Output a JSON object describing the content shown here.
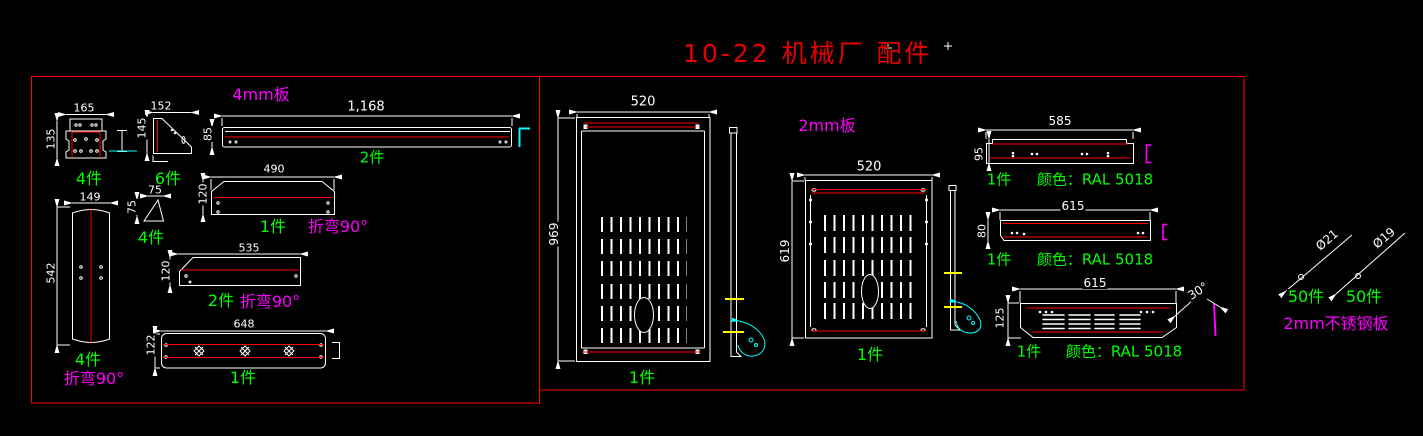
{
  "title": {
    "text": "10-22 机械厂 配件"
  },
  "colors": {
    "w": "#ffffff",
    "g": "#00ff00",
    "m": "#ff00ff",
    "r": "#e60000",
    "line_red": "#ff0000",
    "cyan": "#00ffff",
    "yellow": "#ffff00",
    "background": "#000000"
  },
  "annotations": [
    {
      "name": "dim-bracket-width",
      "text": "165",
      "x": 84,
      "y": 108,
      "s": 11
    },
    {
      "name": "dim-bracket-height",
      "text": "135",
      "x": 51,
      "y": 139,
      "s": 11,
      "rot": -90
    },
    {
      "name": "qty-bracket",
      "text": "4件",
      "x": 89,
      "y": 179,
      "s": 16,
      "c": "g"
    },
    {
      "name": "dim-gusset-width",
      "text": "152",
      "x": 161,
      "y": 106,
      "s": 11
    },
    {
      "name": "dim-gusset-height",
      "text": "145",
      "x": 142,
      "y": 128,
      "s": 11,
      "rot": -90
    },
    {
      "name": "qty-gusset",
      "text": "6件",
      "x": 168,
      "y": 179,
      "s": 16,
      "c": "g"
    },
    {
      "name": "material-left-box",
      "text": "4mm板",
      "x": 261,
      "y": 95,
      "s": 16,
      "c": "m"
    },
    {
      "name": "dim-longbar-length",
      "text": "1,168",
      "x": 366,
      "y": 107,
      "s": 13
    },
    {
      "name": "dim-longbar-height",
      "text": "85",
      "x": 208,
      "y": 134,
      "s": 11,
      "rot": -90
    },
    {
      "name": "qty-longbar",
      "text": "2件",
      "x": 372,
      "y": 158,
      "s": 15,
      "c": "g"
    },
    {
      "name": "dim-tray490-length",
      "text": "490",
      "x": 274,
      "y": 169,
      "s": 11
    },
    {
      "name": "dim-tray490-height",
      "text": "120",
      "x": 203,
      "y": 194,
      "s": 11,
      "rot": -90
    },
    {
      "name": "qty-tray490",
      "text": "1件",
      "x": 273,
      "y": 227,
      "s": 16,
      "c": "g"
    },
    {
      "name": "note-tray490-bend",
      "text": "折弯90°",
      "x": 338,
      "y": 227,
      "s": 16,
      "c": "m"
    },
    {
      "name": "dim-tallpanel-width",
      "text": "149",
      "x": 90,
      "y": 197,
      "s": 11
    },
    {
      "name": "dim-tallpanel-height",
      "text": "542",
      "x": 51,
      "y": 273,
      "s": 11,
      "rot": -90
    },
    {
      "name": "qty-tallpanel",
      "text": "4件",
      "x": 88,
      "y": 360,
      "s": 16,
      "c": "g"
    },
    {
      "name": "note-tallpanel-bend",
      "text": "折弯90°",
      "x": 94,
      "y": 379,
      "s": 16,
      "c": "m"
    },
    {
      "name": "dim-gusset75-width",
      "text": "75",
      "x": 155,
      "y": 190,
      "s": 11
    },
    {
      "name": "dim-gusset75-height",
      "text": "75",
      "x": 132,
      "y": 207,
      "s": 11,
      "rot": -90
    },
    {
      "name": "qty-gusset75",
      "text": "4件",
      "x": 151,
      "y": 238,
      "s": 16,
      "c": "g"
    },
    {
      "name": "dim-tray535-length",
      "text": "535",
      "x": 249,
      "y": 248,
      "s": 11
    },
    {
      "name": "dim-tray535-height",
      "text": "120",
      "x": 166,
      "y": 271,
      "s": 11,
      "rot": -90
    },
    {
      "name": "qty-tray535",
      "text": "2件",
      "x": 221,
      "y": 301,
      "s": 16,
      "c": "g"
    },
    {
      "name": "note-tray535-bend",
      "text": "折弯90°",
      "x": 270,
      "y": 302,
      "s": 16,
      "c": "m"
    },
    {
      "name": "dim-bar648-length",
      "text": "648",
      "x": 244,
      "y": 324,
      "s": 11
    },
    {
      "name": "dim-bar648-height",
      "text": "122",
      "x": 151,
      "y": 345,
      "s": 11,
      "rot": -90
    },
    {
      "name": "qty-bar648",
      "text": "1件",
      "x": 243,
      "y": 378,
      "s": 16,
      "c": "g"
    },
    {
      "name": "dim-panel1-width",
      "text": "520",
      "x": 643,
      "y": 102,
      "s": 13
    },
    {
      "name": "dim-panel1-height",
      "text": "969",
      "x": 554,
      "y": 234,
      "s": 12,
      "rot": -90
    },
    {
      "name": "qty-panel1",
      "text": "1件",
      "x": 642,
      "y": 378,
      "s": 16,
      "c": "g"
    },
    {
      "name": "material-right-box",
      "text": "2mm板",
      "x": 827,
      "y": 126,
      "s": 16,
      "c": "m"
    },
    {
      "name": "dim-panel2-width",
      "text": "520",
      "x": 869,
      "y": 167,
      "s": 13
    },
    {
      "name": "dim-panel2-height",
      "text": "619",
      "x": 785,
      "y": 251,
      "s": 12,
      "rot": -90
    },
    {
      "name": "qty-panel2",
      "text": "1件",
      "x": 870,
      "y": 355,
      "s": 16,
      "c": "g"
    },
    {
      "name": "dim-strip1-length",
      "text": "585",
      "x": 1060,
      "y": 121,
      "s": 12
    },
    {
      "name": "dim-strip1-height",
      "text": "95",
      "x": 979,
      "y": 154,
      "s": 11,
      "rot": -90
    },
    {
      "name": "qty-strip1",
      "text": "1件",
      "x": 999,
      "y": 180,
      "s": 15,
      "c": "g"
    },
    {
      "name": "color-strip1",
      "text": "颜色：RAL 5018",
      "x": 1095,
      "y": 180,
      "s": 15,
      "c": "g"
    },
    {
      "name": "dim-strip2-length",
      "text": "615",
      "x": 1073,
      "y": 206,
      "s": 12
    },
    {
      "name": "dim-strip2-height",
      "text": "80",
      "x": 982,
      "y": 231,
      "s": 11,
      "rot": -90
    },
    {
      "name": "qty-strip2",
      "text": "1件",
      "x": 999,
      "y": 260,
      "s": 15,
      "c": "g"
    },
    {
      "name": "color-strip2",
      "text": "颜色：RAL 5018",
      "x": 1095,
      "y": 260,
      "s": 15,
      "c": "g"
    },
    {
      "name": "dim-strip3-length",
      "text": "615",
      "x": 1095,
      "y": 283,
      "s": 12
    },
    {
      "name": "dim-strip3-height",
      "text": "125",
      "x": 1000,
      "y": 318,
      "s": 11,
      "rot": -90
    },
    {
      "name": "dim-strip3-angle",
      "text": "30°",
      "x": 1198,
      "y": 291,
      "s": 12,
      "rot": -33
    },
    {
      "name": "qty-strip3",
      "text": "1件",
      "x": 1029,
      "y": 352,
      "s": 15,
      "c": "g"
    },
    {
      "name": "color-strip3",
      "text": "颜色：RAL 5018",
      "x": 1124,
      "y": 352,
      "s": 15,
      "c": "g"
    },
    {
      "name": "dia-washer-21",
      "text": "Ø21",
      "x": 1327,
      "y": 240,
      "s": 12,
      "rot": -40
    },
    {
      "name": "dia-washer-19",
      "text": "Ø19",
      "x": 1384,
      "y": 238,
      "s": 12,
      "rot": -40
    },
    {
      "name": "qty-washer-21",
      "text": "50件",
      "x": 1306,
      "y": 297,
      "s": 16,
      "c": "g"
    },
    {
      "name": "qty-washer-19",
      "text": "50件",
      "x": 1364,
      "y": 297,
      "s": 16,
      "c": "g"
    },
    {
      "name": "material-washers",
      "text": "2mm不锈钢板",
      "x": 1336,
      "y": 324,
      "s": 16,
      "c": "m"
    }
  ]
}
